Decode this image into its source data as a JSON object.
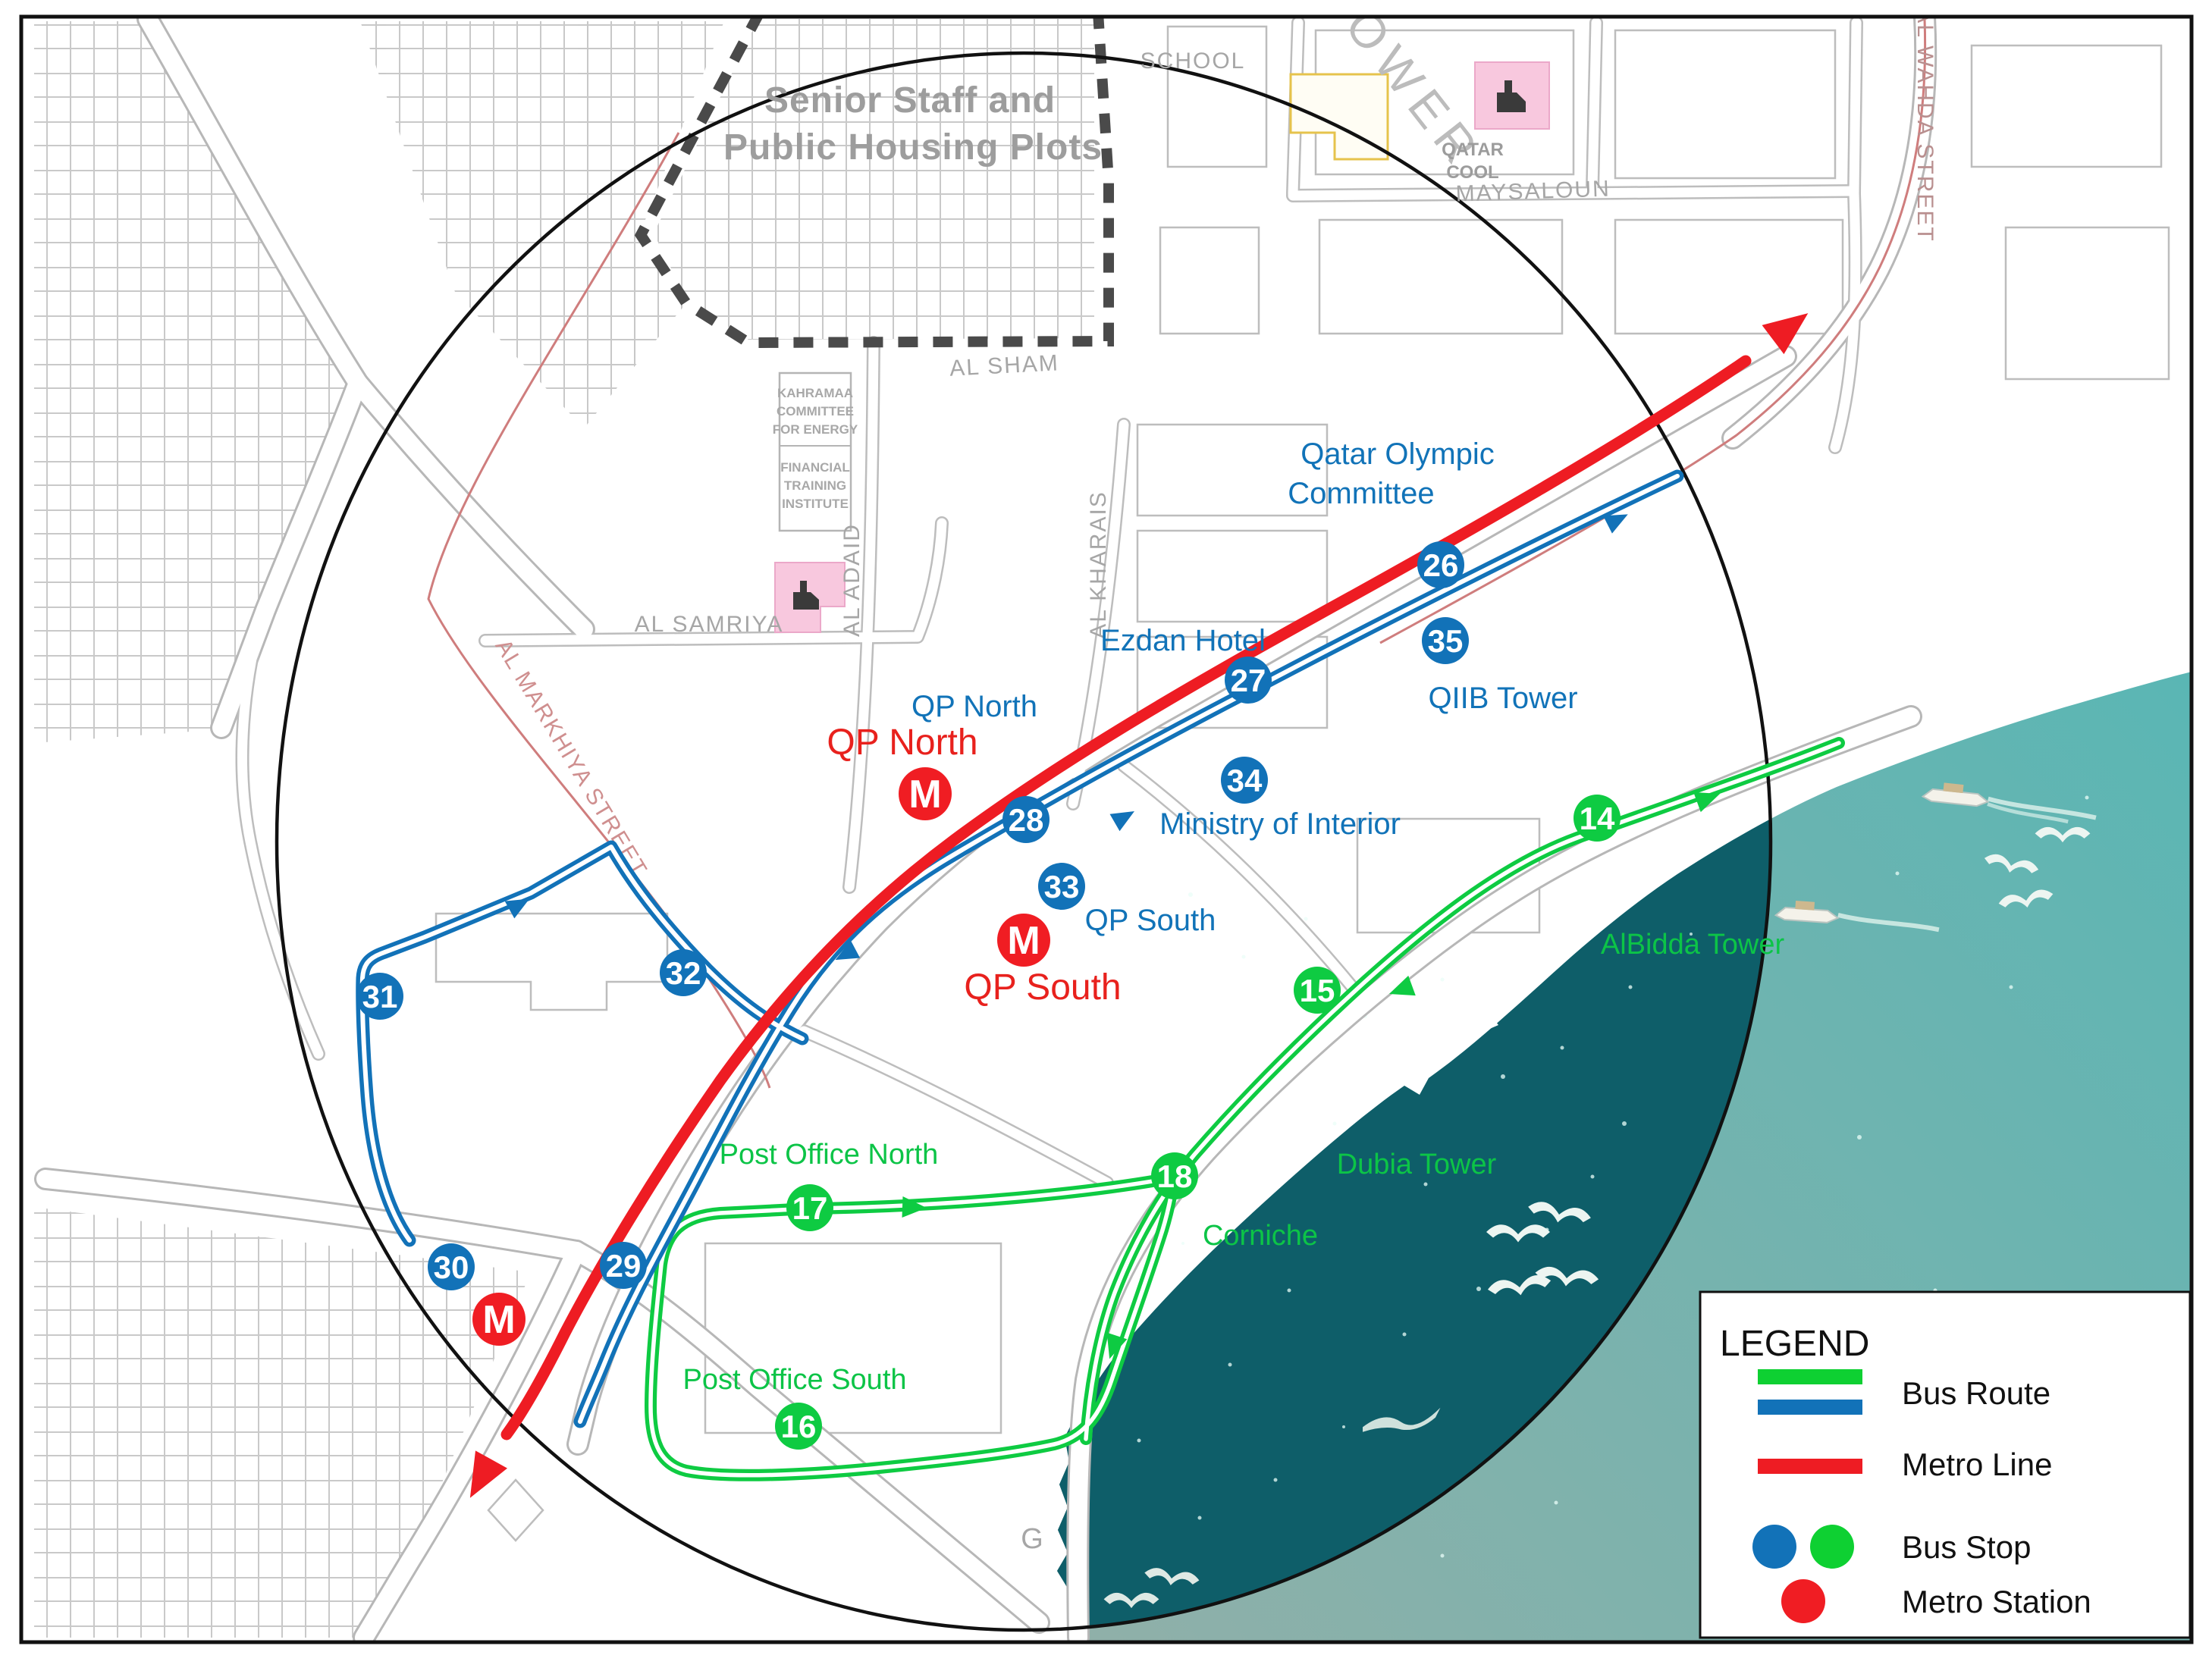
{
  "region": {
    "line1": "Senior Staff and",
    "line2": "Public Housing Plots"
  },
  "streets": {
    "al_sham": "AL SHAM",
    "al_samriya": "AL SAMRIYA",
    "al_adaid": "AL ADAID",
    "al_kharais": "AL KHARAIS",
    "al_markhiya": "AL MARKHIYA STREET",
    "maysaloun": "MAYSALOUN",
    "al_wahda": "AL WAHDA STREET",
    "g_label": "G"
  },
  "facilities": {
    "school": "SCHOOL",
    "tower": "TOWER",
    "qatar_cool_1": "QATAR",
    "qatar_cool_2": "COOL",
    "kahramaa": [
      "KAHRAMAA",
      "COMMITTEE",
      "FOR ENERGY"
    ],
    "fti": [
      "FINANCIAL",
      "TRAINING",
      "INSTITUTE"
    ]
  },
  "pois": {
    "blue": {
      "qoc1": "Qatar Olympic",
      "qoc2": "Committee",
      "ezdan": "Ezdan Hotel",
      "qiib": "QIIB Tower",
      "moi": "Ministry of Interior",
      "qp_north": "QP North",
      "qp_south": "QP South"
    },
    "green": {
      "albidda": "AlBidda Tower",
      "dubia": "Dubia Tower",
      "corniche": "Corniche",
      "po_north": "Post Office North",
      "po_south": "Post Office South"
    },
    "metro": {
      "north": "QP North",
      "south": "QP South",
      "marker": "M"
    }
  },
  "stops": {
    "blue": [
      "26",
      "35",
      "27",
      "34",
      "28",
      "33",
      "32",
      "31",
      "30",
      "29"
    ],
    "green": [
      "14",
      "15",
      "18",
      "17",
      "16"
    ]
  },
  "legend": {
    "title": "LEGEND",
    "bus_route": "Bus Route",
    "metro_line": "Metro Line",
    "bus_stop": "Bus Stop",
    "metro_station": "Metro Station"
  },
  "colors": {
    "bus_blue": "#1272b8",
    "bus_green": "#0ecb42",
    "metro_red": "#ee1c23",
    "sea_light": "#6fb5b0",
    "sea_dark": "#0e5e69"
  }
}
